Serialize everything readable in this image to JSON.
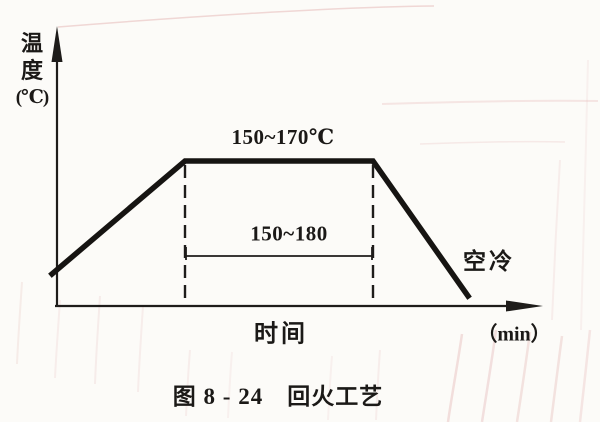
{
  "colors": {
    "ink": "#1e1c1a",
    "paper": "#fcfbf8",
    "scan_artifact_pink": "#e3b4b2"
  },
  "chart_data": {
    "type": "line",
    "title": "图 8 - 24　回火工艺",
    "xlabel": "时间",
    "x_unit": "（min）",
    "ylabel": "温度（℃）",
    "ylabel_lines": [
      "温",
      "度",
      "(℃)"
    ],
    "x_axis_ticks": [],
    "y_axis_ticks": [],
    "annotations": {
      "hold_temperature": "150~170℃",
      "hold_duration_min": "150~180",
      "cooling_method": "空冷"
    },
    "series": [
      {
        "name": "回火工艺曲线",
        "description": "升温至150~170℃，保温150~180 min，随后空冷",
        "phases": [
          "加热",
          "保温 150~170℃ / 150~180 min",
          "空冷"
        ]
      }
    ],
    "geometry": {
      "y_axis": "57,306 57,44",
      "y_arrow": "51.5,62 57,26 62.5,62",
      "x_axis": "55,306 522,306",
      "x_arrow": "506,300.5 543,306 506,311.5",
      "curve": "52,274 185,161 373,161 468,296",
      "dash_left": "185,165 185,304",
      "dash_right": "373,165 373,304",
      "dim_path": "M186,256 L372,256 M186,247 L186,260 M372,247 L372,260"
    }
  }
}
